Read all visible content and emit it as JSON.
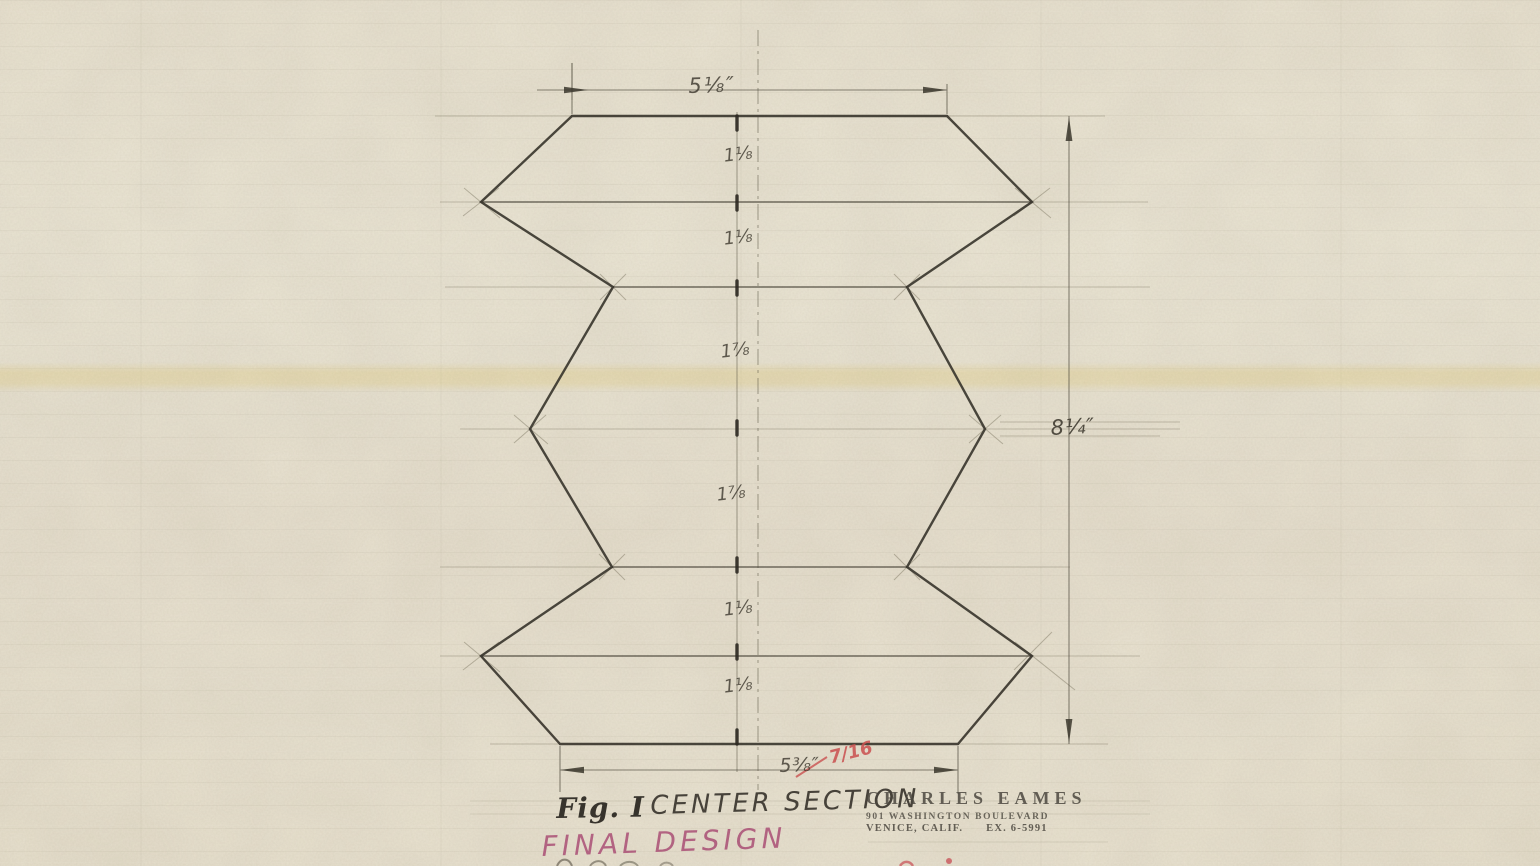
{
  "drawing": {
    "dimensions": {
      "top": "5⅛″",
      "right": "8¼″",
      "bottom": "5⅜″",
      "bottom_correction": "7/16",
      "segments": [
        "1⅛",
        "1⅛",
        "1⅞",
        "1⅞",
        "1⅛",
        "1⅛"
      ]
    },
    "caption": {
      "figure": "Fig. I",
      "title": "CENTER SECTION"
    },
    "annotation": {
      "final_design": "FINAL DESIGN"
    },
    "stamp": {
      "name": "CHARLES EAMES",
      "address": "901 WASHINGTON BOULEVARD",
      "city_phone": "VENICE, CALIF.      EX. 6-5991"
    },
    "colors": {
      "pencil": "#3f3a30",
      "red_ink": "#d25252",
      "magenta_marker": "#b0517b",
      "paper": "#e7e0cd"
    }
  }
}
